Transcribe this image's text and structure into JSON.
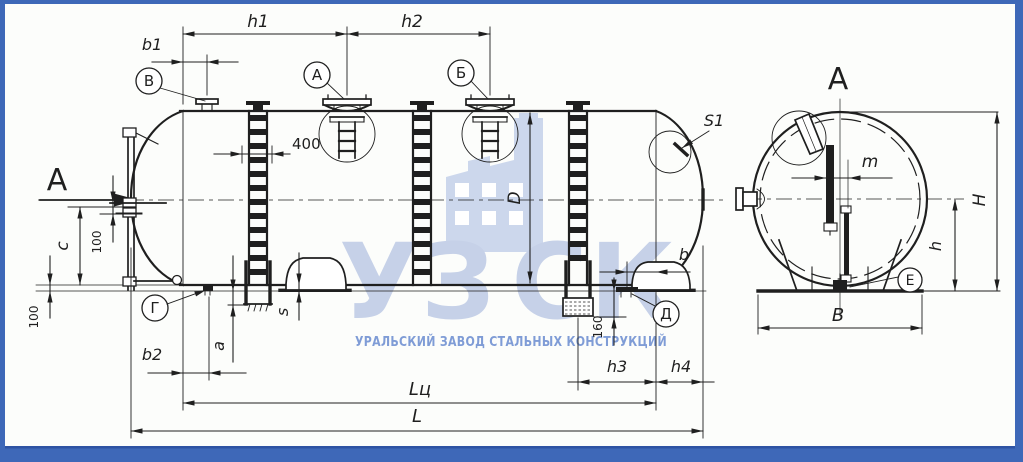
{
  "views": {
    "arrow": "А",
    "title": "А"
  },
  "dims": {
    "h1": "h1",
    "h2": "h2",
    "b1": "b1",
    "b2": "b2",
    "h3": "h3",
    "h4": "h4",
    "L": "L",
    "Lc": "Lц",
    "D": "D",
    "H": "H",
    "B": "B",
    "h": "h",
    "m": "m",
    "a": "a",
    "b": "b",
    "c": "c",
    "s": "s",
    "S1": "S1",
    "d400": "400",
    "n100a": "100",
    "n100b": "100",
    "n160": "160"
  },
  "marks": {
    "V": "В",
    "A": "А",
    "B": "Б",
    "G": "Г",
    "D": "Д",
    "E": "Е"
  },
  "watermark": {
    "logo_left": "УЗ",
    "logo_right": "СК",
    "subtitle": "УРАЛЬСКИЙ ЗАВОД СТАЛЬНЫХ КОНСТРУКЦИЙ"
  },
  "colors": {
    "frame": "#3e68b8",
    "line": "#1f1f1f",
    "paper": "#fcfdfb",
    "wm_letters": "#c6d1e8",
    "wm_icon": "#ccd7ec",
    "subtitle": "#7f9cd6"
  }
}
